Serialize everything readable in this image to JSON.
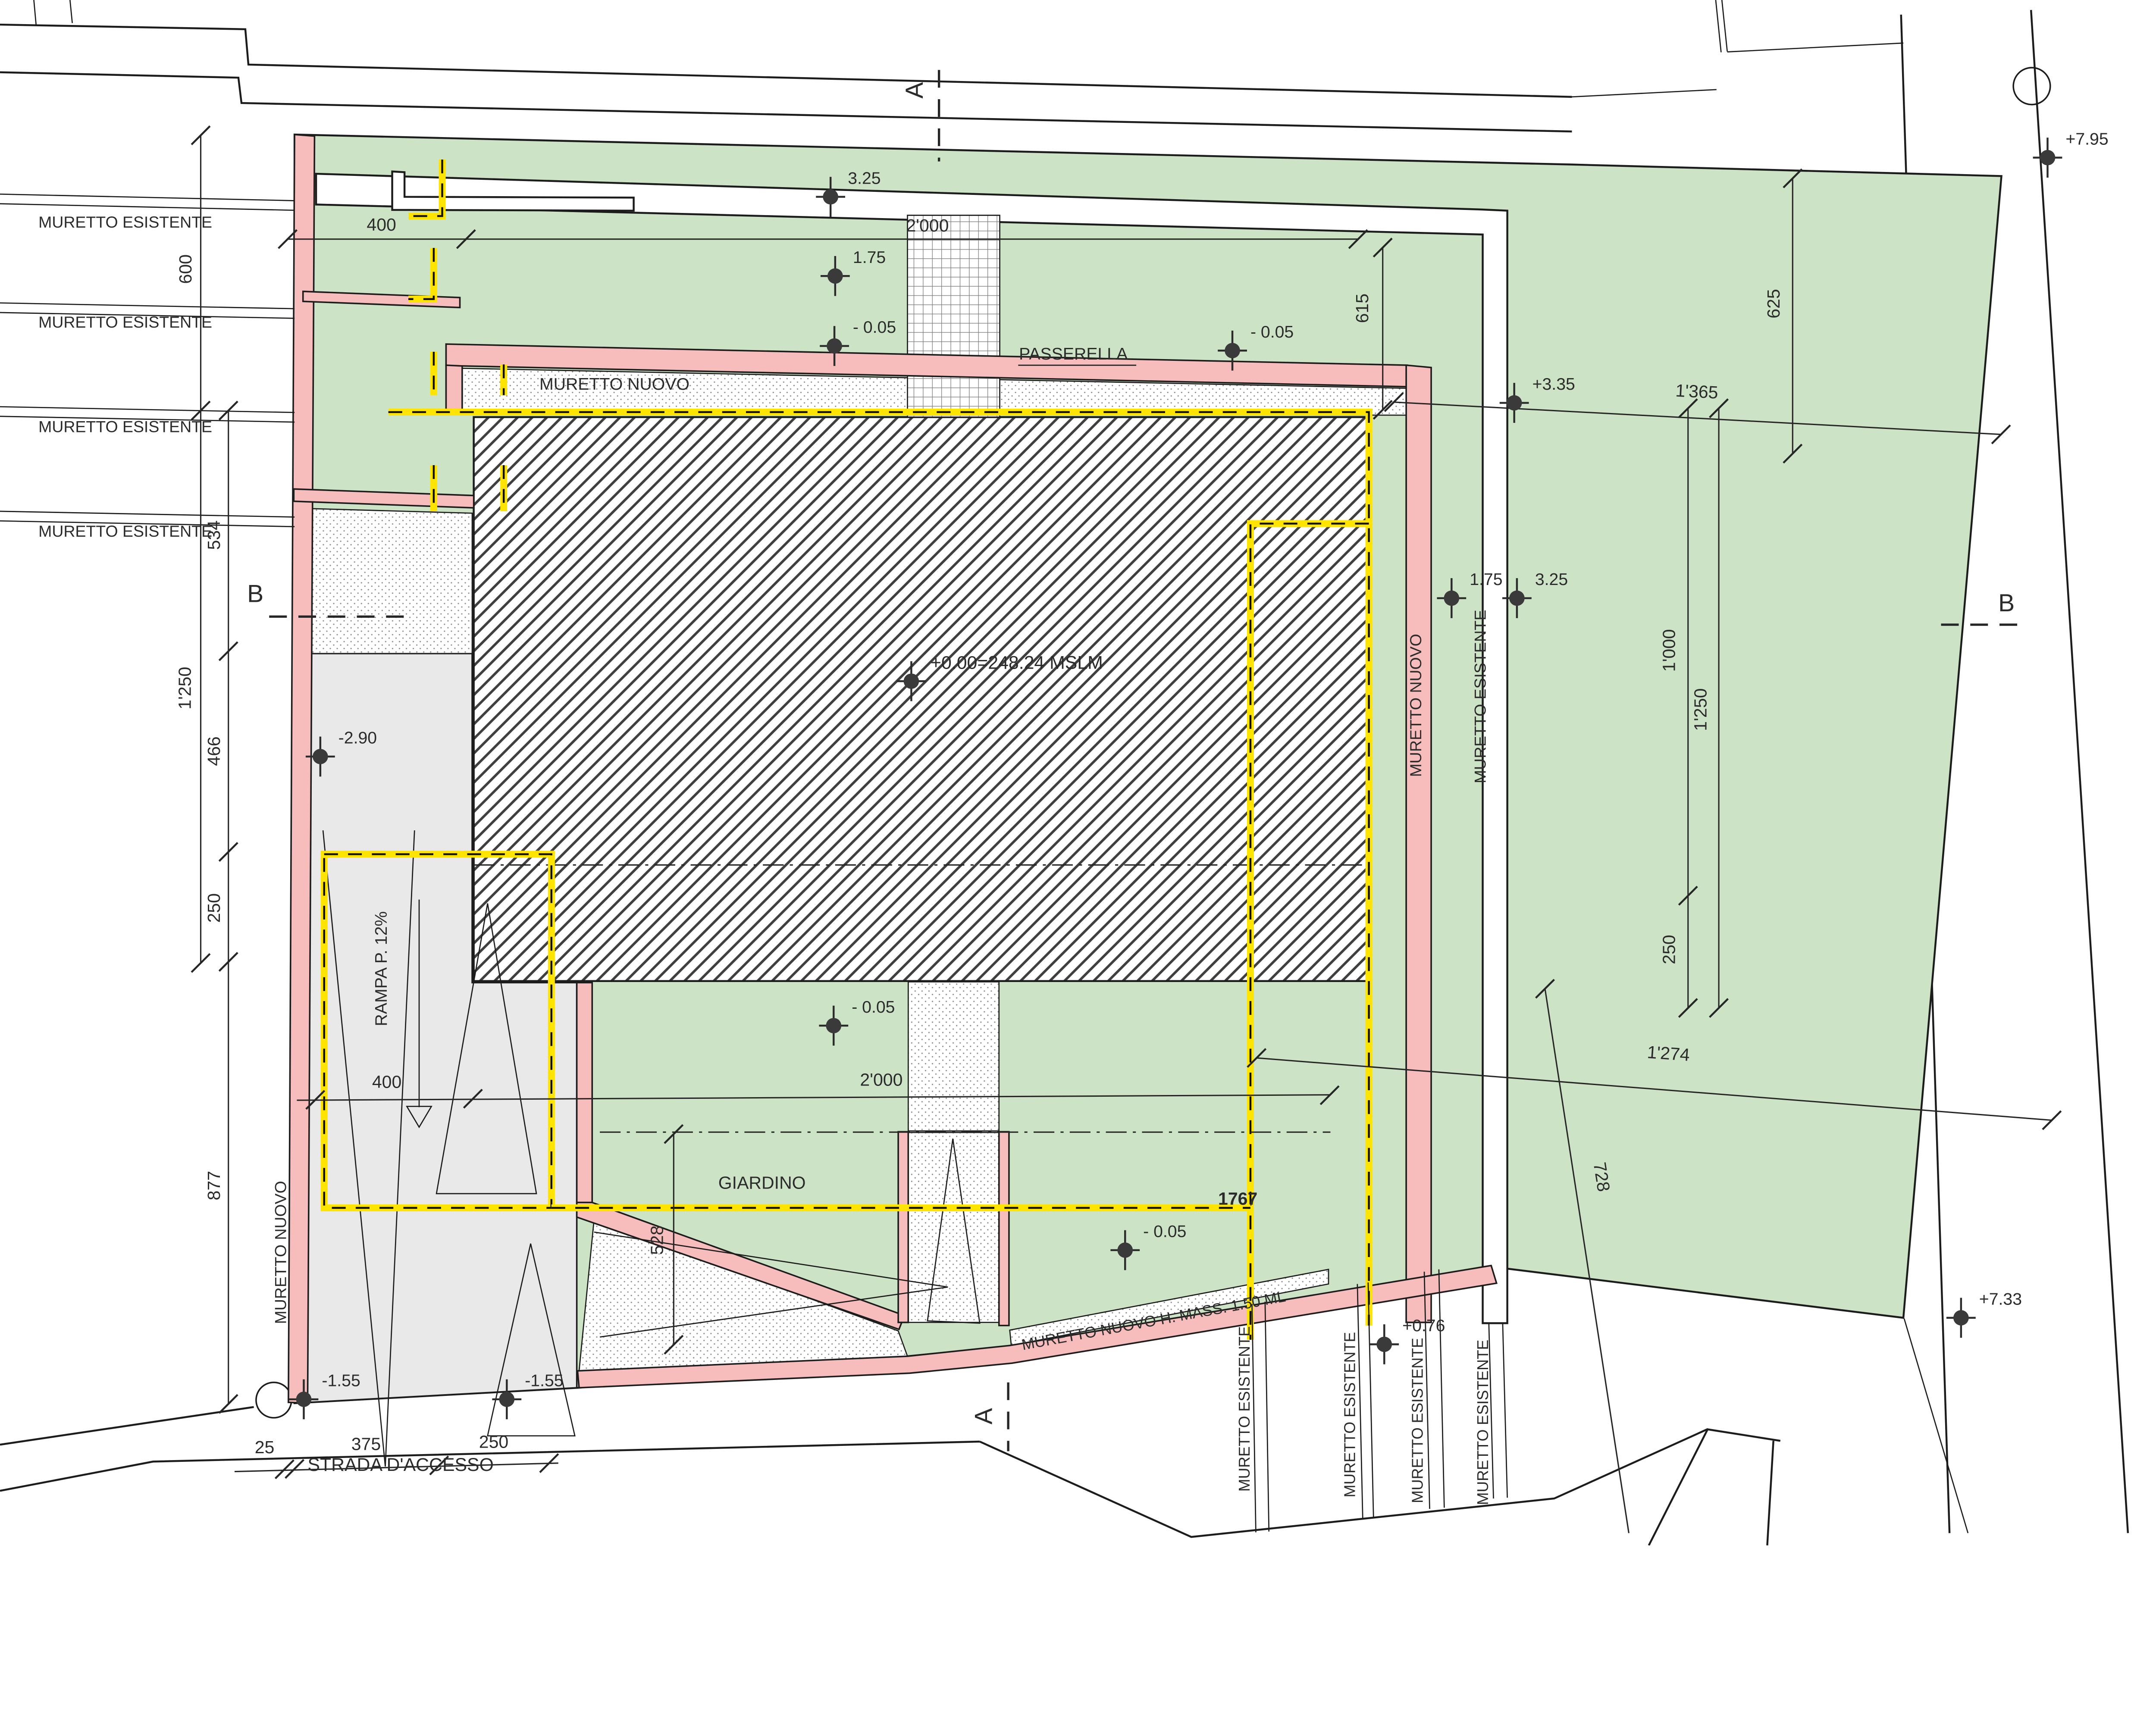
{
  "colors": {
    "site_green": "#cde3c6",
    "new_wall_pink": "#f7bcbc",
    "boundary_yellow": "#ffe400",
    "ramp_gray": "#e9e9e9",
    "line_black": "#1c1c1c"
  },
  "walls": {
    "left_rows": [
      "MURETTO ESISTENTE",
      "MURETTO ESISTENTE",
      "MURETTO ESISTENTE",
      "MURETTO ESISTENTE"
    ],
    "muretto_nuovo_top": "MURETTO NUOVO",
    "muretto_nuovo_right": "MURETTO NUOVO",
    "muretto_esistente_right": "MURETTO ESISTENTE",
    "muretto_nuovo_left": "MURETTO NUOVO",
    "muretto_nuovo_hmax": "MURETTO NUOVO H. MASS. 1.50 ML",
    "bottom_rows": [
      "MURETTO ESISTENTE",
      "MURETTO ESISTENTE",
      "MURETTO ESISTENTE",
      "MURETTO ESISTENTE"
    ]
  },
  "areas": {
    "giardino": "GIARDINO",
    "passerella": "PASSERELLA",
    "rampa": "RAMPA P. 12%",
    "strada": "STRADA D'ACCESSO",
    "parcel": "1767"
  },
  "sections": {
    "a_top": "A",
    "a_bottom": "A",
    "b_left": "B",
    "b_right": "B"
  },
  "elevations": {
    "e_325_top": "3.25",
    "e_175_top": "1.75",
    "e_005_top": "- 0.05",
    "e_005_pass": "- 0.05",
    "e_335": "+3.35",
    "e_175_right": "1.75",
    "e_325_right": "3.25",
    "e_795": "+7.95",
    "e_290": "-2.90",
    "e_000": "+0.00=248.24 MSLM",
    "e_005_giardino": "- 0.05",
    "e_005_lower": "- 0.05",
    "e_155_a": "-1.55",
    "e_155_b": "-1.55",
    "e_076": "+0.76",
    "e_733": "+7.33"
  },
  "dimensions": {
    "top_400": "400",
    "top_2000": "2'000",
    "left_600": "600",
    "left_534": "534",
    "left_1250": "1'250",
    "left_466": "466",
    "left_250": "250",
    "left_877": "877",
    "bot_25": "25",
    "bot_375": "375",
    "bot_250": "250",
    "ramp_400": "400",
    "giardino_2000": "2'000",
    "giardino_528": "528",
    "right_615": "615",
    "right_625": "625",
    "right_1365": "1'365",
    "right_1000": "1'000",
    "right_1250": "1'250",
    "right_250": "250",
    "right_1274": "1'274",
    "right_728": "728"
  }
}
